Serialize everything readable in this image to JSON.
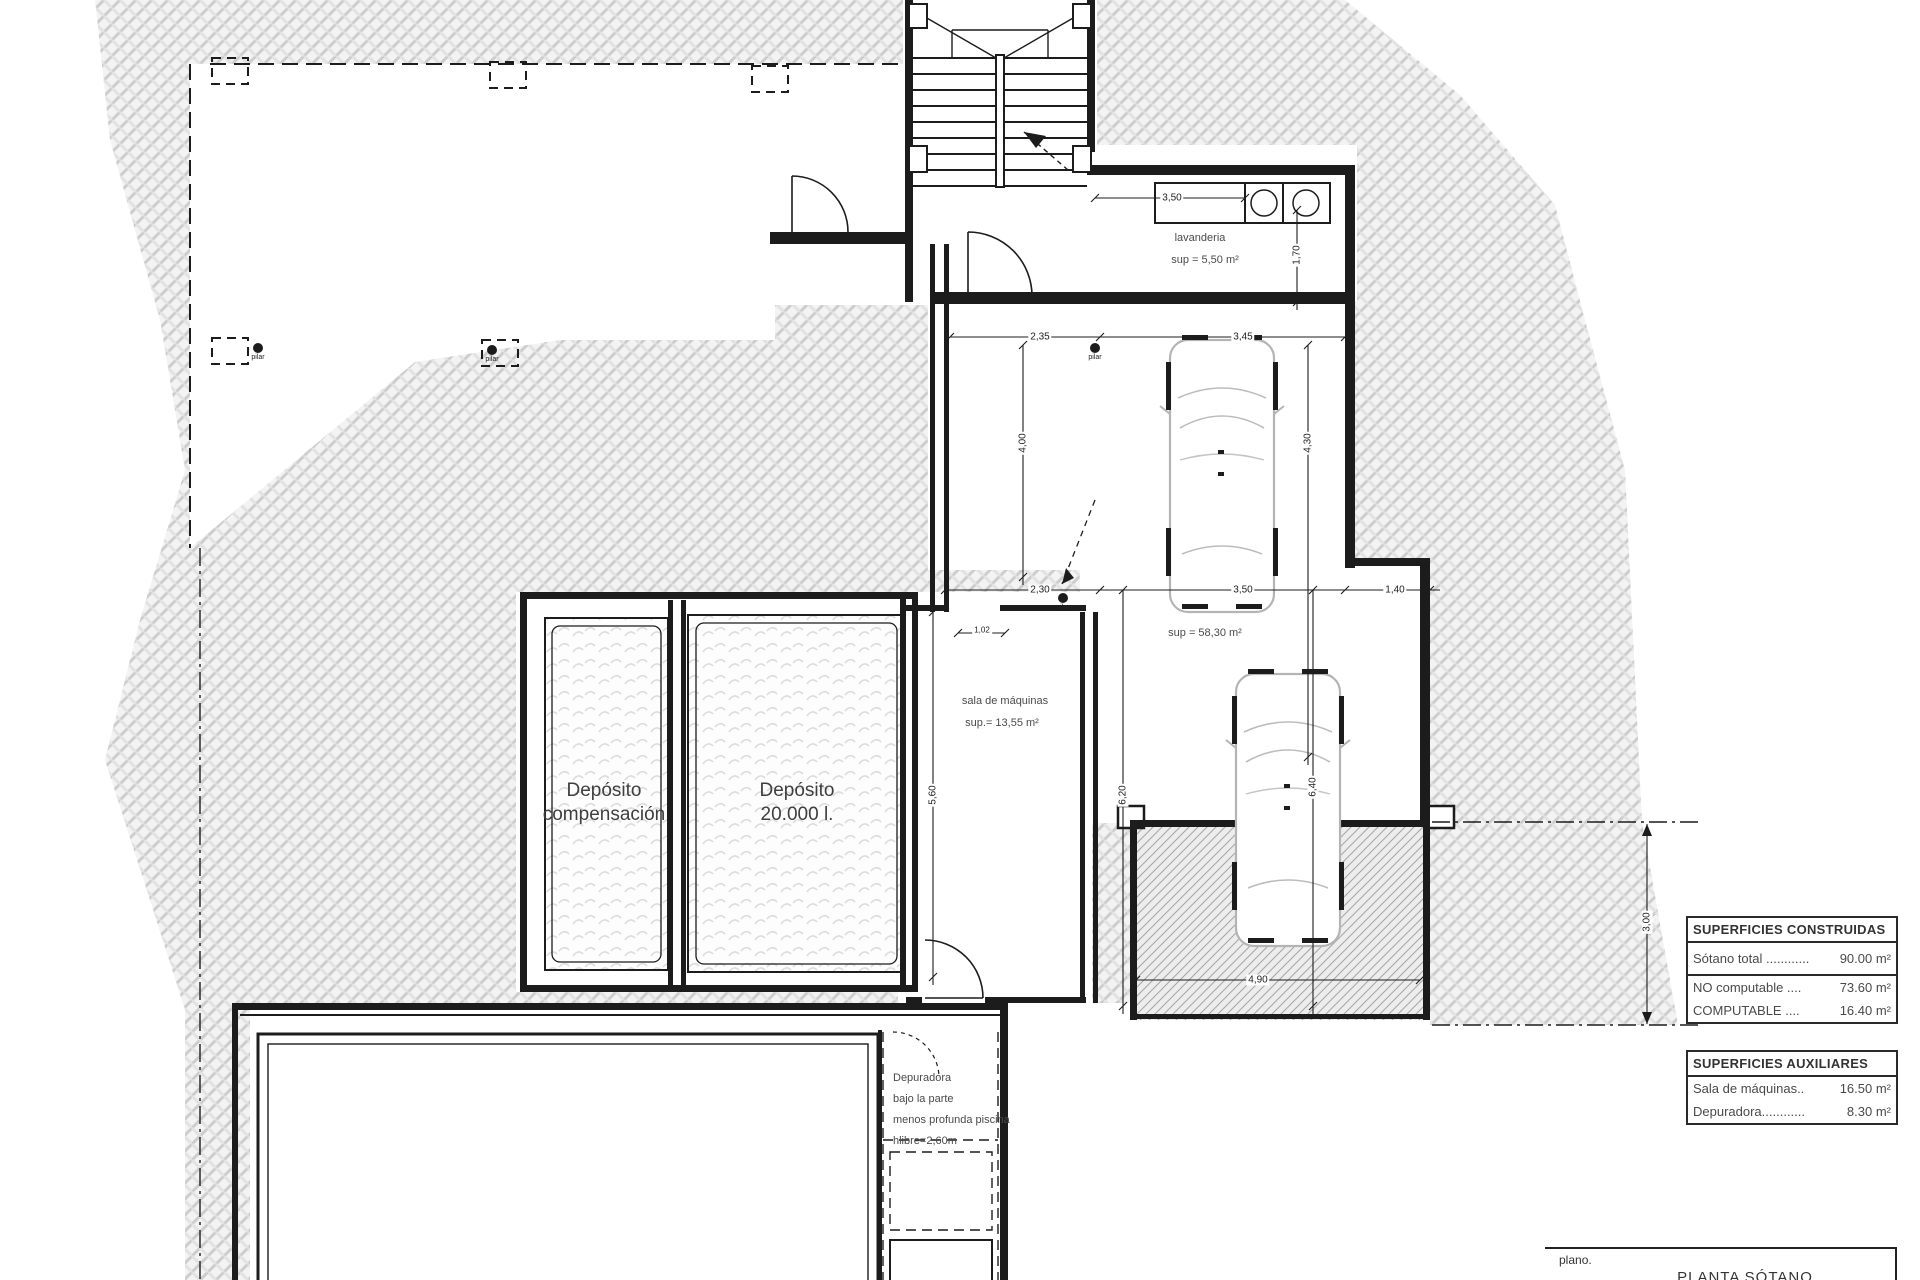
{
  "title_block": {
    "plano_label": "plano.",
    "plan_title": "PLANTA SÓTANO"
  },
  "tables": {
    "constructed": {
      "header": "SUPERFICIES CONSTRUIDAS",
      "rows": [
        {
          "label": "Sótano total ............",
          "value": "90.00 m²"
        },
        {
          "label": "NO computable ....",
          "value": "73.60 m²"
        },
        {
          "label": "COMPUTABLE    ....",
          "value": "16.40 m²"
        }
      ]
    },
    "auxiliary": {
      "header": "SUPERFICIES AUXILIARES",
      "rows": [
        {
          "label": "Sala de máquinas..",
          "value": "16.50 m²"
        },
        {
          "label": "Depuradora............",
          "value": "8.30 m²"
        }
      ]
    }
  },
  "rooms": {
    "laundry": {
      "name": "lavanderia",
      "area": "sup = 5,50 m²"
    },
    "garage": {
      "area": "sup = 58,30 m²"
    },
    "machine_room": {
      "name": "sala de máquinas",
      "area": "sup.= 13,55 m²"
    },
    "tank_compensation": {
      "line1": "Depósito",
      "line2": "compensación"
    },
    "tank_20000": {
      "line1": "Depósito",
      "line2": "20.000 l."
    },
    "depuradora_note": {
      "line1": "Depuradora",
      "line2": "bajo la parte",
      "line3": "menos profunda piscina",
      "line4": "hlibre=2,60m"
    }
  },
  "dimensions": {
    "d350_top": "3,50",
    "d170": "1,70",
    "d235": "2,35",
    "d345": "3,45",
    "d400": "4,00",
    "d430": "4,30",
    "d230": "2,30",
    "d350_mid": "3,50",
    "d140": "1,40",
    "d102": "1,02",
    "d560": "5,60",
    "d620": "6,20",
    "d640": "6,40",
    "d490": "4,90",
    "d300": "3,00"
  },
  "markers": {
    "pilar": "pilar"
  }
}
